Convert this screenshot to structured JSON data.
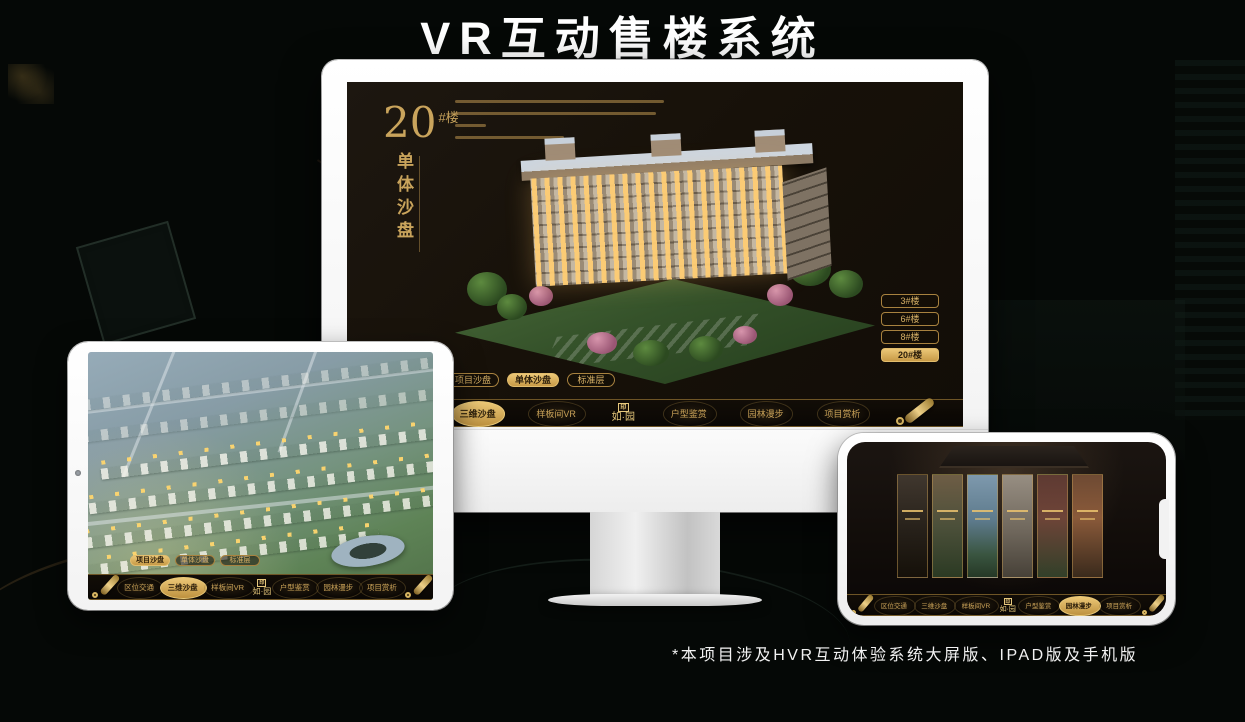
{
  "page": {
    "title": "VR互动售楼系统",
    "footnote": "*本项目涉及HVR互动体验系统大屏版、IPAD版及手机版"
  },
  "colors": {
    "gold": "#c9a258",
    "gold_fill": "#e0b76a",
    "screen_bg": "#171109",
    "bar_bg": "#0c0805"
  },
  "monitor": {
    "building_no": "20",
    "building_no_suffix": "#楼",
    "subtitle": "单体沙盘",
    "floor_buttons": [
      {
        "label": "3#楼",
        "active": false
      },
      {
        "label": "6#楼",
        "active": false
      },
      {
        "label": "8#楼",
        "active": false
      },
      {
        "label": "20#楼",
        "active": true
      }
    ],
    "view_tabs": [
      {
        "label": "项目沙盘",
        "active": false
      },
      {
        "label": "单体沙盘",
        "active": true
      },
      {
        "label": "标准层",
        "active": false
      }
    ],
    "nav": {
      "items": [
        {
          "label": "区位交通",
          "active": false
        },
        {
          "label": "三维沙盘",
          "active": true
        },
        {
          "label": "样板间VR",
          "active": false
        },
        {
          "label": "户型鉴赏",
          "active": false
        },
        {
          "label": "园林漫步",
          "active": false
        },
        {
          "label": "项目赏析",
          "active": false
        }
      ],
      "logo_seal": "印",
      "logo_text": "如·园"
    }
  },
  "ipad": {
    "view_tabs": [
      {
        "label": "项目沙盘",
        "active": true
      },
      {
        "label": "单体沙盘",
        "active": false
      },
      {
        "label": "标准层",
        "active": false
      }
    ],
    "nav": {
      "items": [
        {
          "label": "区位交通",
          "active": false
        },
        {
          "label": "三维沙盘",
          "active": true
        },
        {
          "label": "样板间VR",
          "active": false
        },
        {
          "label": "户型鉴赏",
          "active": false
        },
        {
          "label": "园林漫步",
          "active": false
        },
        {
          "label": "项目赏析",
          "active": false
        }
      ],
      "logo_seal": "印",
      "logo_text": "如·园"
    }
  },
  "phone": {
    "nav": {
      "items": [
        {
          "label": "区位交通",
          "active": false
        },
        {
          "label": "三维沙盘",
          "active": false
        },
        {
          "label": "样板间VR",
          "active": false
        },
        {
          "label": "户型鉴赏",
          "active": false
        },
        {
          "label": "园林漫步",
          "active": true
        },
        {
          "label": "项目赏析",
          "active": false
        }
      ],
      "logo_seal": "印",
      "logo_text": "如·园"
    }
  }
}
